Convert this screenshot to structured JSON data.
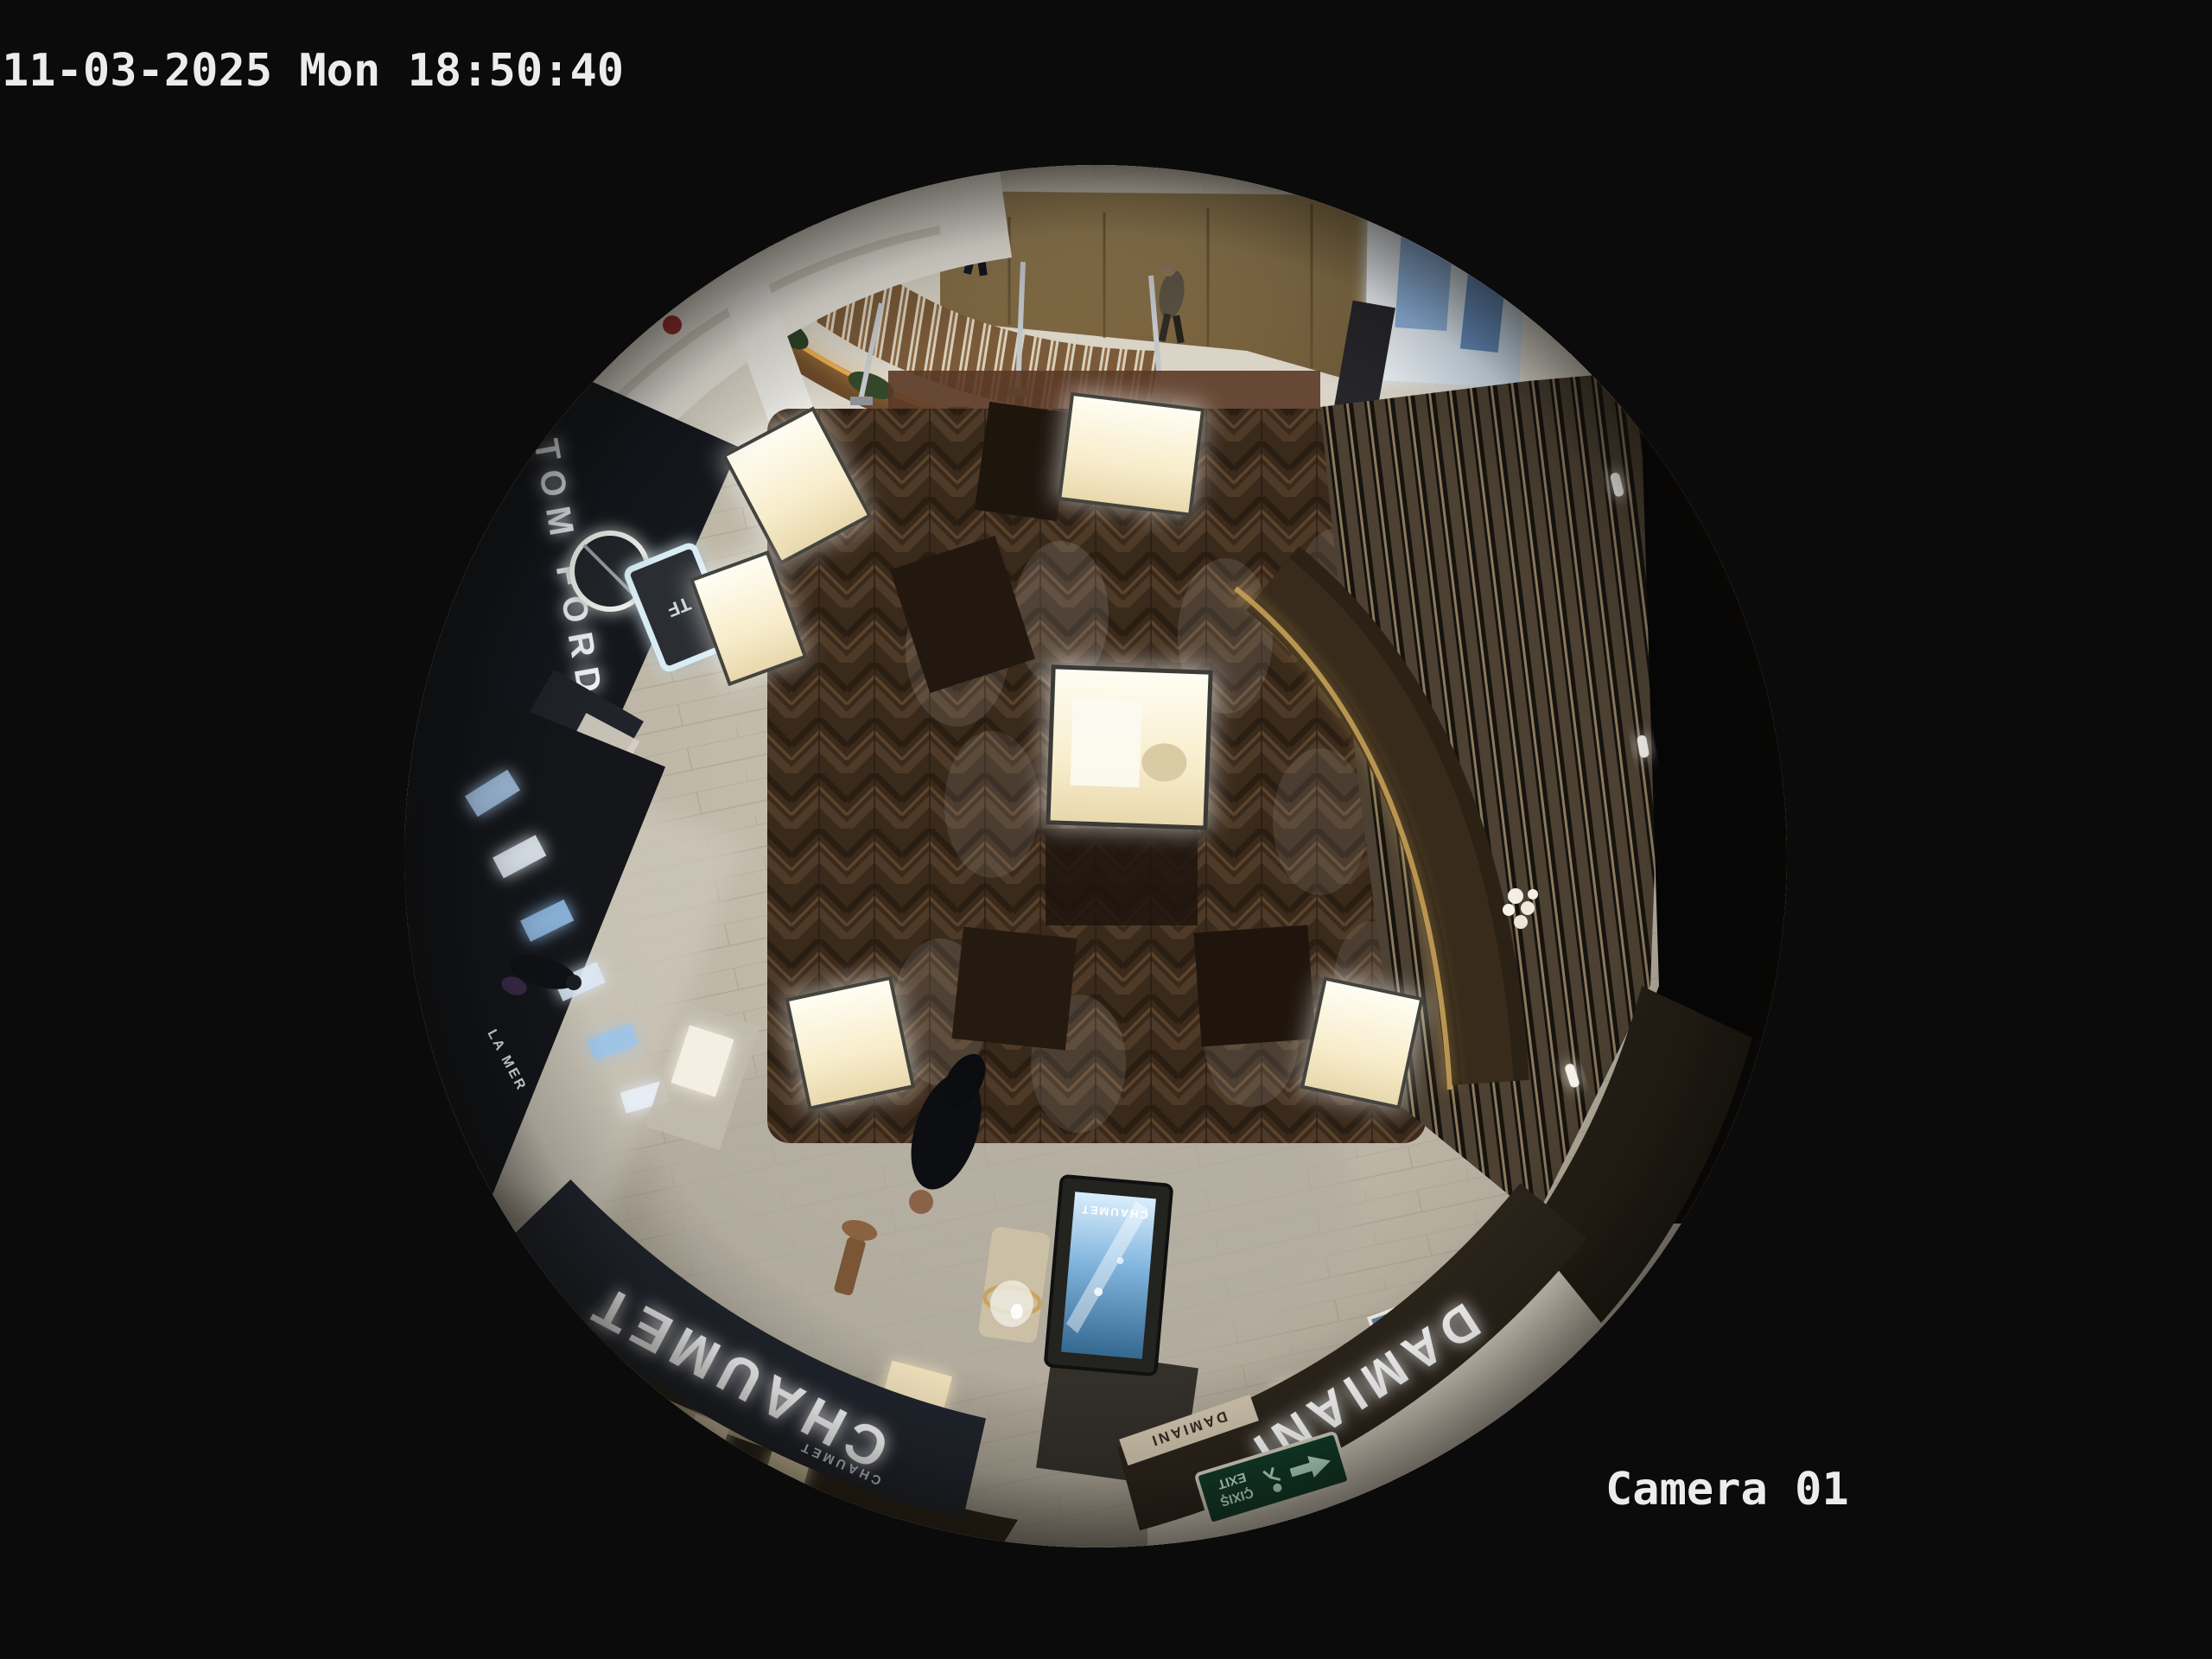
{
  "overlay": {
    "timestamp": "11-03-2025 Mon 18:50:40",
    "camera_label": "Camera 01"
  },
  "signs": {
    "tom_ford": "TOM FORD",
    "tf_logo": "TF",
    "chaumet_main": "CHAUMET",
    "chaumet_small": "CHAUMET",
    "chaumet_screen": "CHAUMET",
    "damiani_main": "DAMIANI",
    "damiani_small": "DAMIANI",
    "la_mer": "LA MER",
    "exit_line1": "ÇIXIŞ",
    "exit_line2": "EXIT"
  },
  "palette": {
    "background": "#0b0b0b",
    "overlay_text": "#ececec",
    "wood_floor": "#3a291b",
    "marble_walkway": "#c6bfae",
    "fascia_dark": "#20242c",
    "showcase_glow": "#fdf4d8",
    "counter_gold": "#c9a258",
    "kiosk_screen_blue": "#5a9fd4",
    "exit_sign_green": "#123d2a",
    "slat_wood": "#4c4132"
  }
}
